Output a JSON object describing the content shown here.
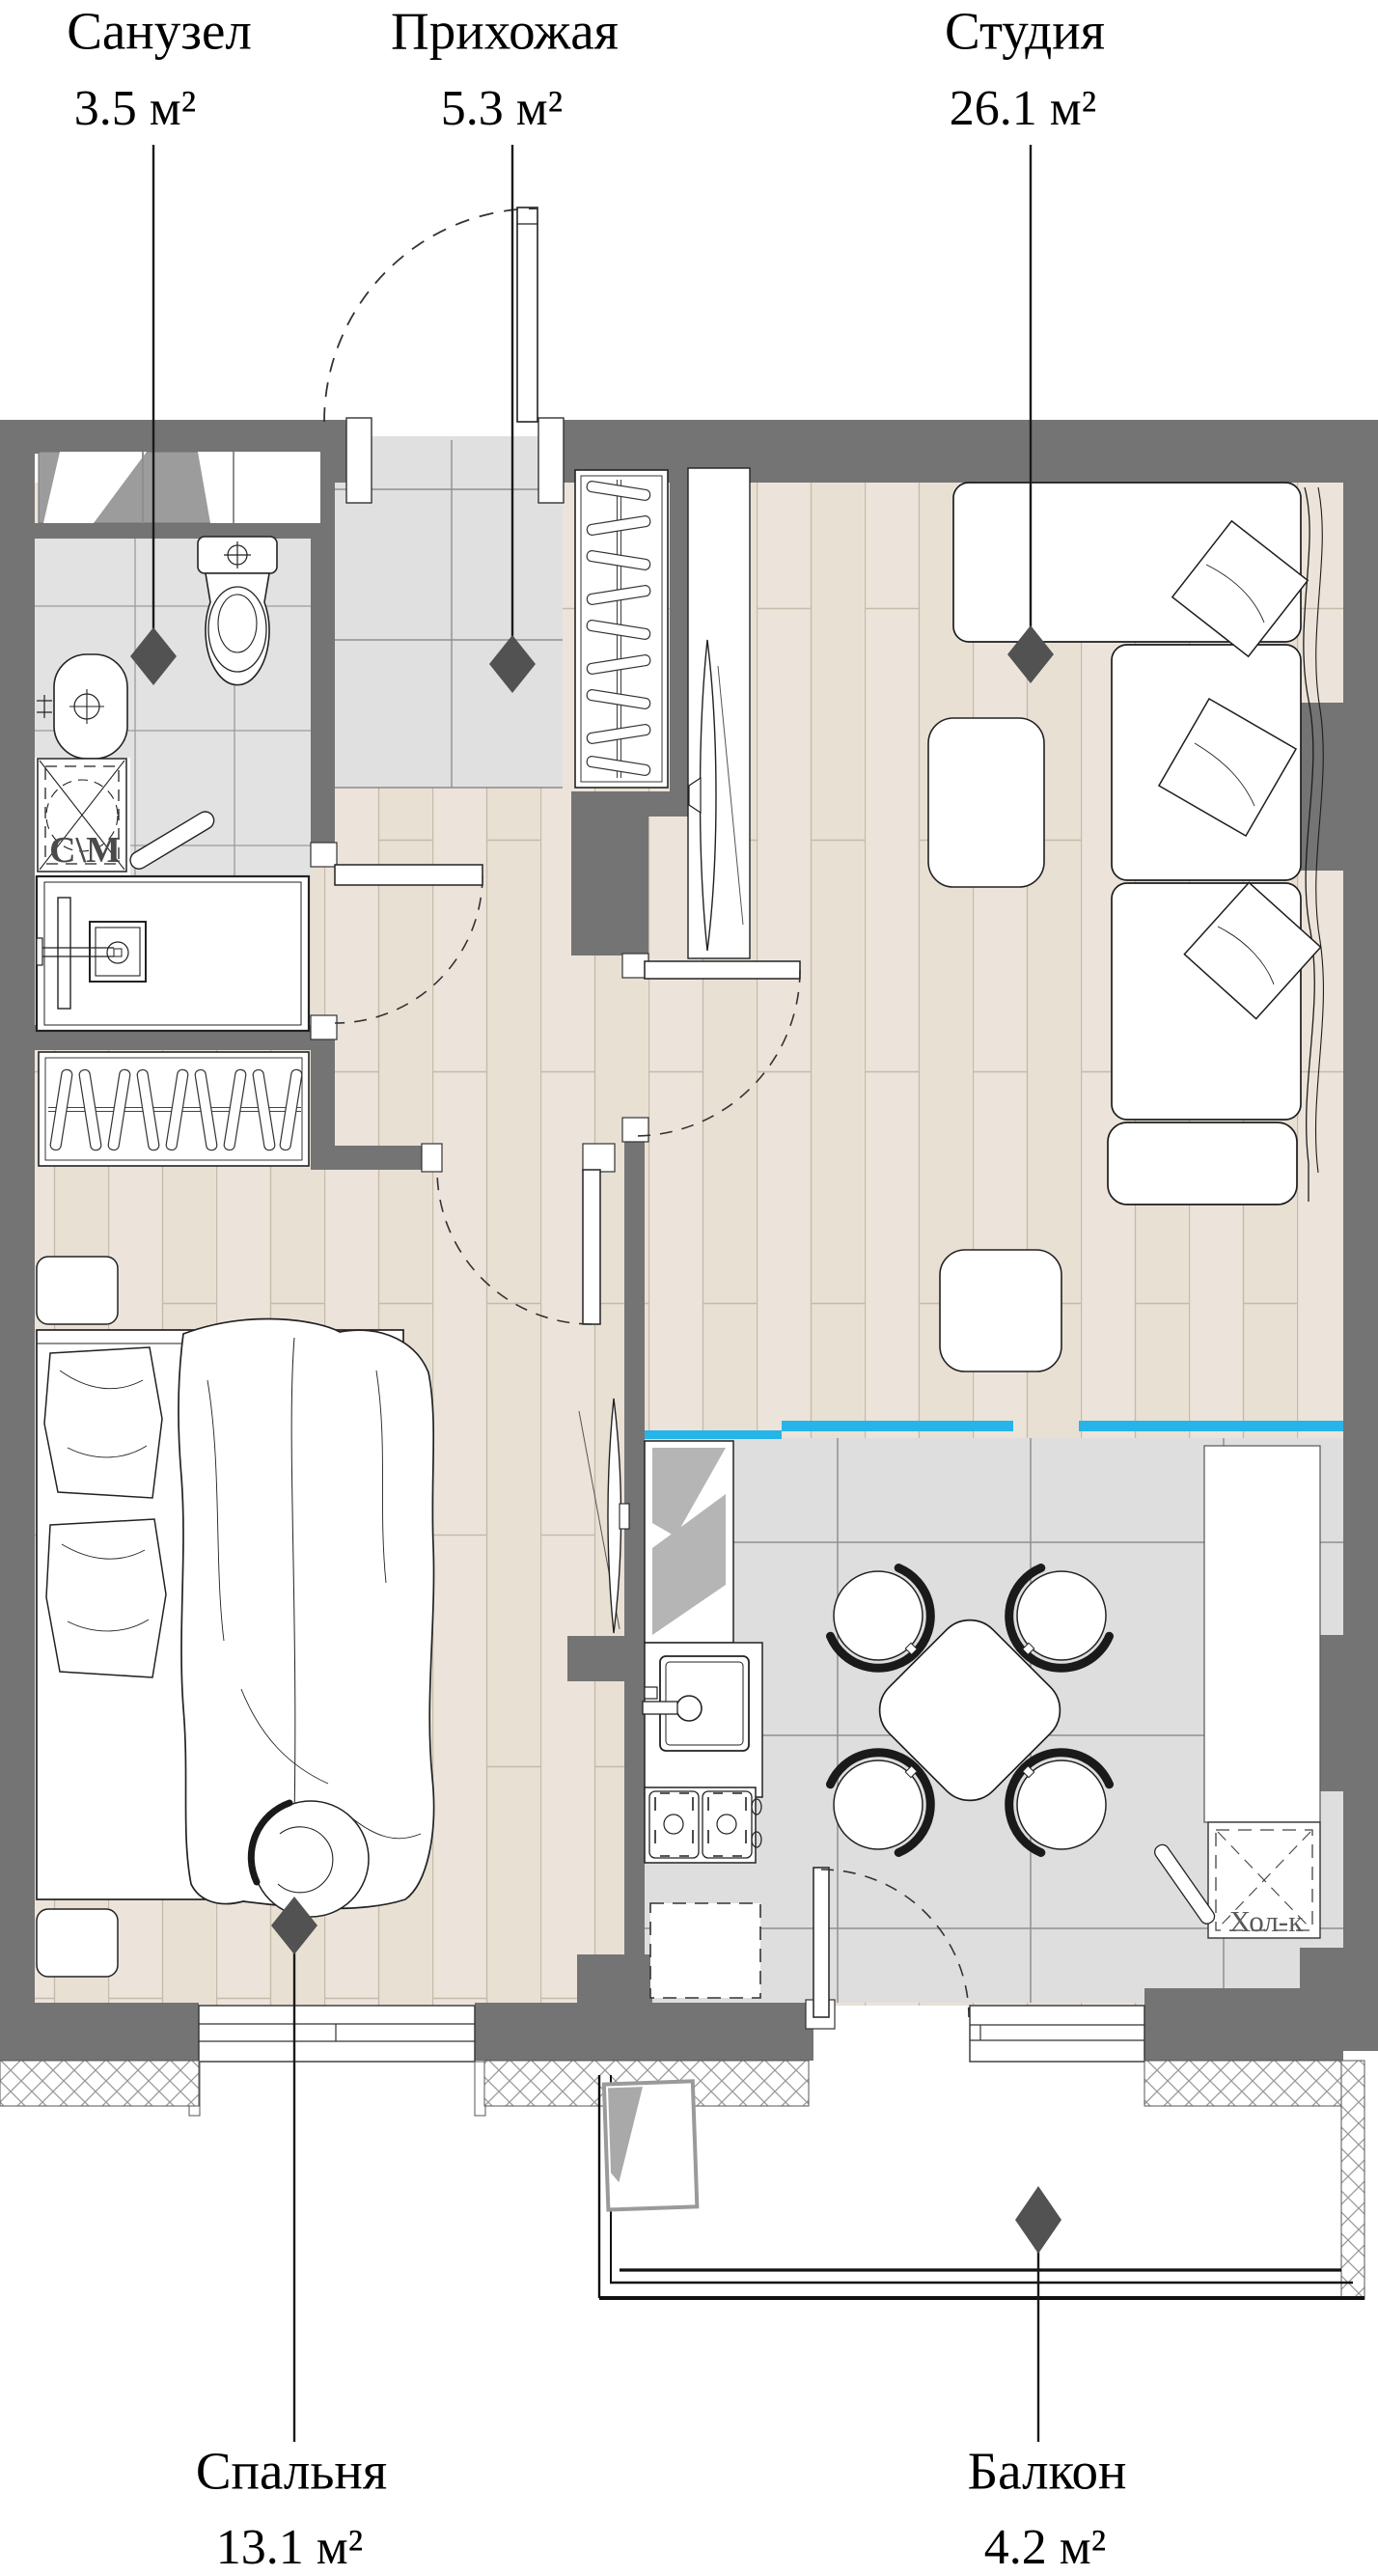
{
  "plan_title": "Floor plan of studio apartment",
  "rooms": [
    {
      "id": "sanuzel",
      "label": "Санузел",
      "area": "3.5 м²"
    },
    {
      "id": "prihozhaya",
      "label": "Прихожая",
      "area": "5.3 м²"
    },
    {
      "id": "studia",
      "label": "Студия",
      "area": "26.1 м²"
    },
    {
      "id": "spalnya",
      "label": "Спальня",
      "area": "13.1 м²"
    },
    {
      "id": "balkon",
      "label": "Балкон",
      "area": "4.2 м²"
    }
  ],
  "appliance_labels": {
    "washing_machine": "С\\М",
    "refrigerator": "Хол-к"
  },
  "colors": {
    "wall": "#747474",
    "zone_divider_cyan": "#27b4e8",
    "marker": "#525252",
    "wood_floor": "#ece4da",
    "tile_floor": "#e2e2e2",
    "kitchen_tile": "#dedede"
  }
}
